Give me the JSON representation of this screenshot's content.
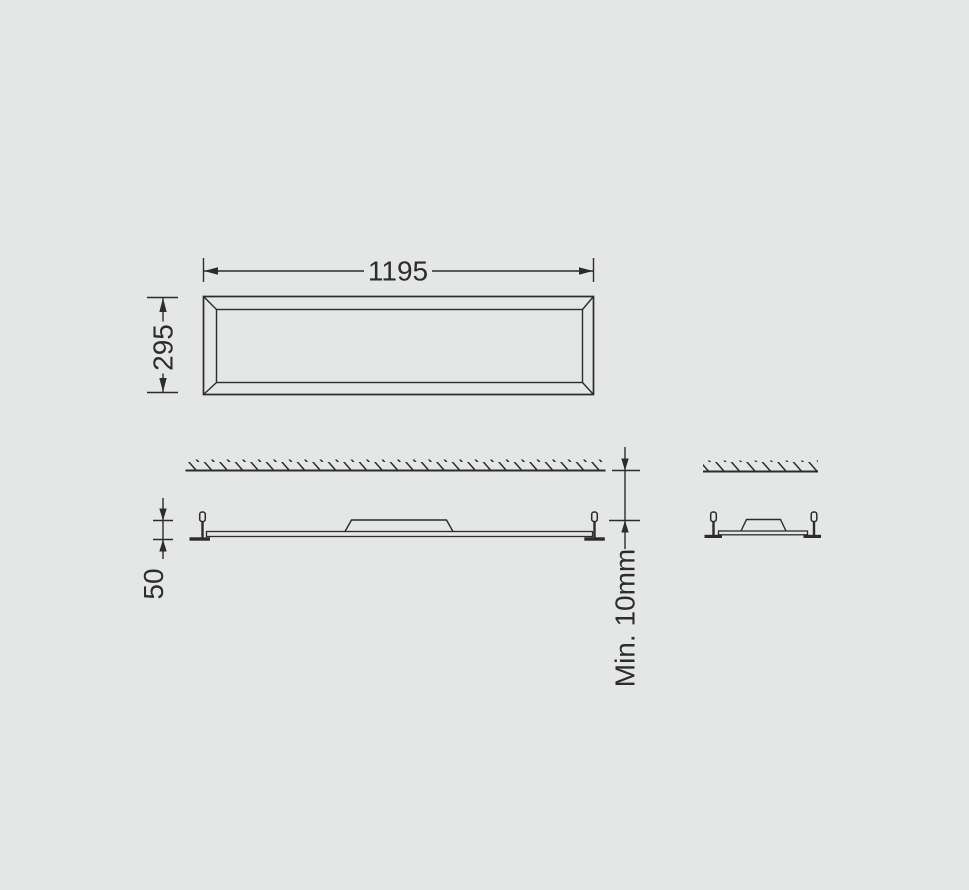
{
  "colors": {
    "background": "#e5e6e6",
    "line": "#2c2c2c"
  },
  "dimensions": {
    "panel_width_label": "1195",
    "panel_height_label": "295",
    "fixture_height_label": "50",
    "ceiling_clearance_label": "Min. 10mm"
  }
}
